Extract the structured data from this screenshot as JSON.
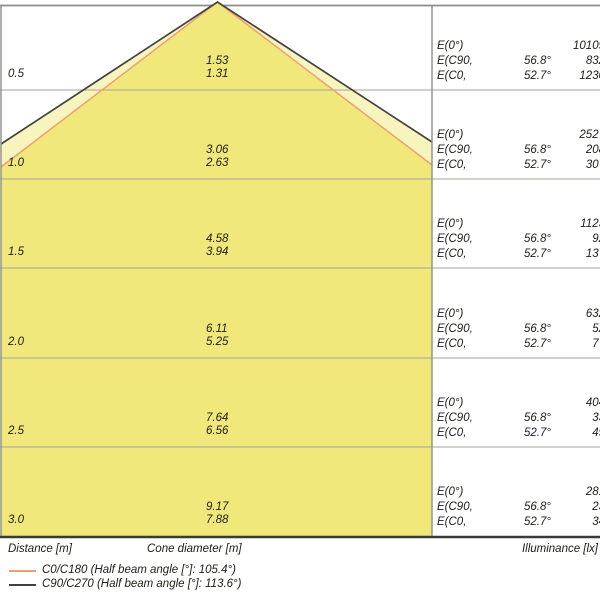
{
  "colors": {
    "cone_outer_fill": "#f8f4bd",
    "cone_inner_fill": "#f0e87b",
    "cone_outer_line": "#45433c",
    "cone_inner_line": "#ee9f72",
    "gridline": "#a5a49a",
    "frame": "#8d8c85",
    "bottom_border": "#3b3a34",
    "text": "#21201c"
  },
  "axis_labels": {
    "distance": "Distance [m]",
    "cone_diameter": "Cone diameter [m]",
    "illuminance": "Illuminance [lx]"
  },
  "legend": [
    {
      "label": "C0/C180 (Half beam angle [°]: 105.4°)",
      "color": "#ee9f72"
    },
    {
      "label": "C90/C270 (Half beam angle [°]: 113.6°)",
      "color": "#42403a"
    }
  ],
  "rows": [
    {
      "distance": "0.5",
      "diam_c90": "1.53",
      "diam_c0": "1.31",
      "e0_label": "E(0°)",
      "e0_angle": "",
      "e0_value": "10109",
      "ec90_label": "E(C90,",
      "ec90_angle": "56.8°",
      "ec90_value": "832",
      "ec0_label": "E(C0,",
      "ec0_angle": "52.7°",
      "ec0_value": "1230"
    },
    {
      "distance": "1.0",
      "diam_c90": "3.06",
      "diam_c0": "2.63",
      "e0_label": "E(0°)",
      "e0_angle": "",
      "e0_value": "2527",
      "ec90_label": "E(C90,",
      "ec90_angle": "56.8°",
      "ec90_value": "208",
      "ec0_label": "E(C0,",
      "ec0_angle": "52.7°",
      "ec0_value": "307"
    },
    {
      "distance": "1.5",
      "diam_c90": "4.58",
      "diam_c0": "3.94",
      "e0_label": "E(0°)",
      "e0_angle": "",
      "e0_value": "1123",
      "ec90_label": "E(C90,",
      "ec90_angle": "56.8°",
      "ec90_value": "92",
      "ec0_label": "E(C0,",
      "ec0_angle": "52.7°",
      "ec0_value": "137"
    },
    {
      "distance": "2.0",
      "diam_c90": "6.11",
      "diam_c0": "5.25",
      "e0_label": "E(0°)",
      "e0_angle": "",
      "e0_value": "632",
      "ec90_label": "E(C90,",
      "ec90_angle": "56.8°",
      "ec90_value": "52",
      "ec0_label": "E(C0,",
      "ec0_angle": "52.7°",
      "ec0_value": "77"
    },
    {
      "distance": "2.5",
      "diam_c90": "7.64",
      "diam_c0": "6.56",
      "e0_label": "E(0°)",
      "e0_angle": "",
      "e0_value": "404",
      "ec90_label": "E(C90,",
      "ec90_angle": "56.8°",
      "ec90_value": "33",
      "ec0_label": "E(C0,",
      "ec0_angle": "52.7°",
      "ec0_value": "49"
    },
    {
      "distance": "3.0",
      "diam_c90": "9.17",
      "diam_c0": "7.88",
      "e0_label": "E(0°)",
      "e0_angle": "",
      "e0_value": "281",
      "ec90_label": "E(C90,",
      "ec90_angle": "56.8°",
      "ec90_value": "23",
      "ec0_label": "E(C0,",
      "ec0_angle": "52.7°",
      "ec0_value": "34"
    }
  ],
  "chart_data": {
    "type": "table",
    "title": "Luminous cone diagram",
    "distance_m": [
      0.5,
      1.0,
      1.5,
      2.0,
      2.5,
      3.0
    ],
    "series": [
      {
        "name": "Cone diameter C90/C270 [m]",
        "values": [
          1.53,
          3.06,
          4.58,
          6.11,
          7.64,
          9.17
        ]
      },
      {
        "name": "Cone diameter C0/C180 [m]",
        "values": [
          1.31,
          2.63,
          3.94,
          5.25,
          6.56,
          7.88
        ]
      },
      {
        "name": "E(0°) [lx]",
        "values": [
          10109,
          2527,
          1123,
          632,
          404,
          281
        ]
      },
      {
        "name": "E(C90, 56.8°) [lx]",
        "values": [
          832,
          208,
          92,
          52,
          33,
          23
        ]
      },
      {
        "name": "E(C0, 52.7°) [lx]",
        "values": [
          1230,
          307,
          137,
          77,
          49,
          34
        ]
      }
    ],
    "legend_entries": [
      "C0/C180 (Half beam angle [°]: 105.4°)",
      "C90/C270 (Half beam angle [°]: 113.6°)"
    ],
    "layout": {
      "half_beam_angle_c0_c180_deg": 105.4,
      "half_beam_angle_c90_c270_deg": 113.6,
      "grid": true,
      "legend_position": "bottom-left"
    }
  }
}
